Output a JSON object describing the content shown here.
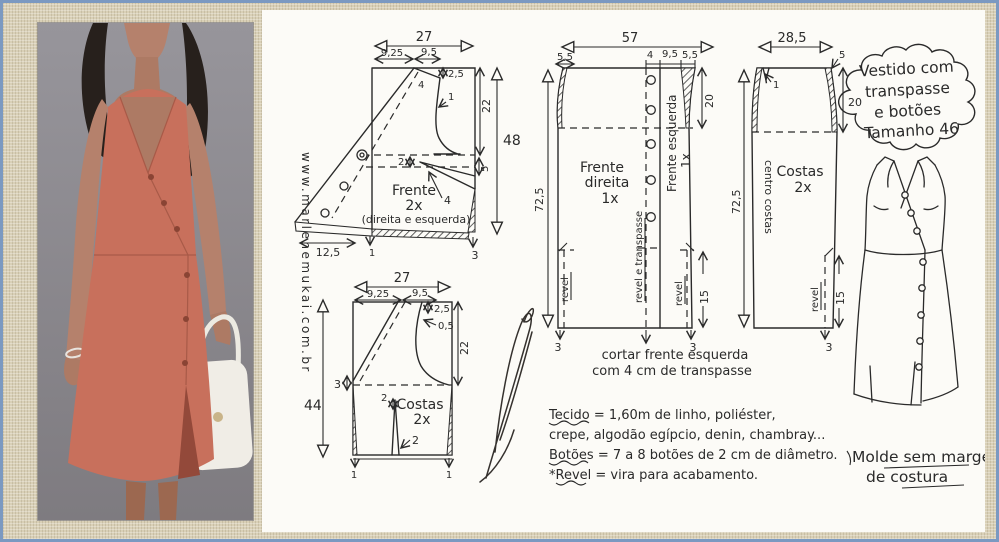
{
  "colors": {
    "frame_border": "#7b99c1",
    "linen": "#d9d0b7",
    "paper": "#fcfbf7",
    "ink": "#2a2a2a",
    "dress": "#c8705c",
    "photo_bg": "#8e8c92"
  },
  "watermark": "www.marlenemukai.com.br",
  "title_bubble": {
    "lines": [
      "Vestido com",
      "transpasse",
      "e botões",
      "Tamanho 46"
    ]
  },
  "bodice_front": {
    "name": [
      "Frente",
      "2x",
      "(direita e esquerda)"
    ],
    "dims": {
      "top_width": "27",
      "shoulder_left": "9,25",
      "shoulder_right": "9,5",
      "neck_drop": "2,5",
      "armhole_curve": "1",
      "side_length": "22",
      "total_length": "48",
      "shoulder_seam": "4",
      "dart_width": "2",
      "dart_point": "4",
      "side_dip": "5",
      "wrap_width": "12,5",
      "hem_mid": "1",
      "hem_corner": "3"
    }
  },
  "bodice_back": {
    "name": [
      "Costas",
      "2x"
    ],
    "dims": {
      "top_width": "27",
      "shoulder_left": "9,25",
      "shoulder_right": "9,5",
      "neck_drop": "2,5",
      "armhole_curve": "0,5",
      "side_length": "22",
      "total_length": "44",
      "waist_dip": "3",
      "dart_width": "2",
      "dart_bottom": "2",
      "hem_left": "1",
      "hem_right": "1"
    }
  },
  "skirt_front": {
    "name_right": [
      "Frente",
      "direita",
      "1x"
    ],
    "name_left": "Frente esquerda",
    "name_left_qty": "1x",
    "facing_center": "revel e transpasse",
    "facing_left": "revel",
    "facing_right": "revel",
    "cut_note": [
      "cortar frente esquerda",
      "com 4 cm de transpasse"
    ],
    "dims": {
      "top_width": "57",
      "side_left": "5,5",
      "overlap": "4",
      "center_gap": "9,5",
      "side_right": "5,5",
      "hip_depth": "20",
      "length": "72,5",
      "hem_facing": "15",
      "hem_left": "3",
      "hem_right": "3"
    }
  },
  "skirt_back": {
    "name": [
      "Costas",
      "2x"
    ],
    "center_fold": "centro costas",
    "facing": "revel",
    "dims": {
      "top_width": "28,5",
      "side_right": "5",
      "shoulder_dart": "1",
      "hip_depth": "20",
      "length": "72,5",
      "hem_facing": "15",
      "hem_corner": "3"
    }
  },
  "notes": {
    "fabric_line1": "Tecido = 1,60m de linho, poliéster,",
    "fabric_line2": "crepe, algodão egípcio, denin, chambray...",
    "buttons_line": "Botões = 7 a 8 botões de 2 cm de diâmetro.",
    "revel_line": "*Revel = vira para acabamento."
  },
  "sketch_caption": [
    "Molde sem margem",
    "de costura"
  ]
}
